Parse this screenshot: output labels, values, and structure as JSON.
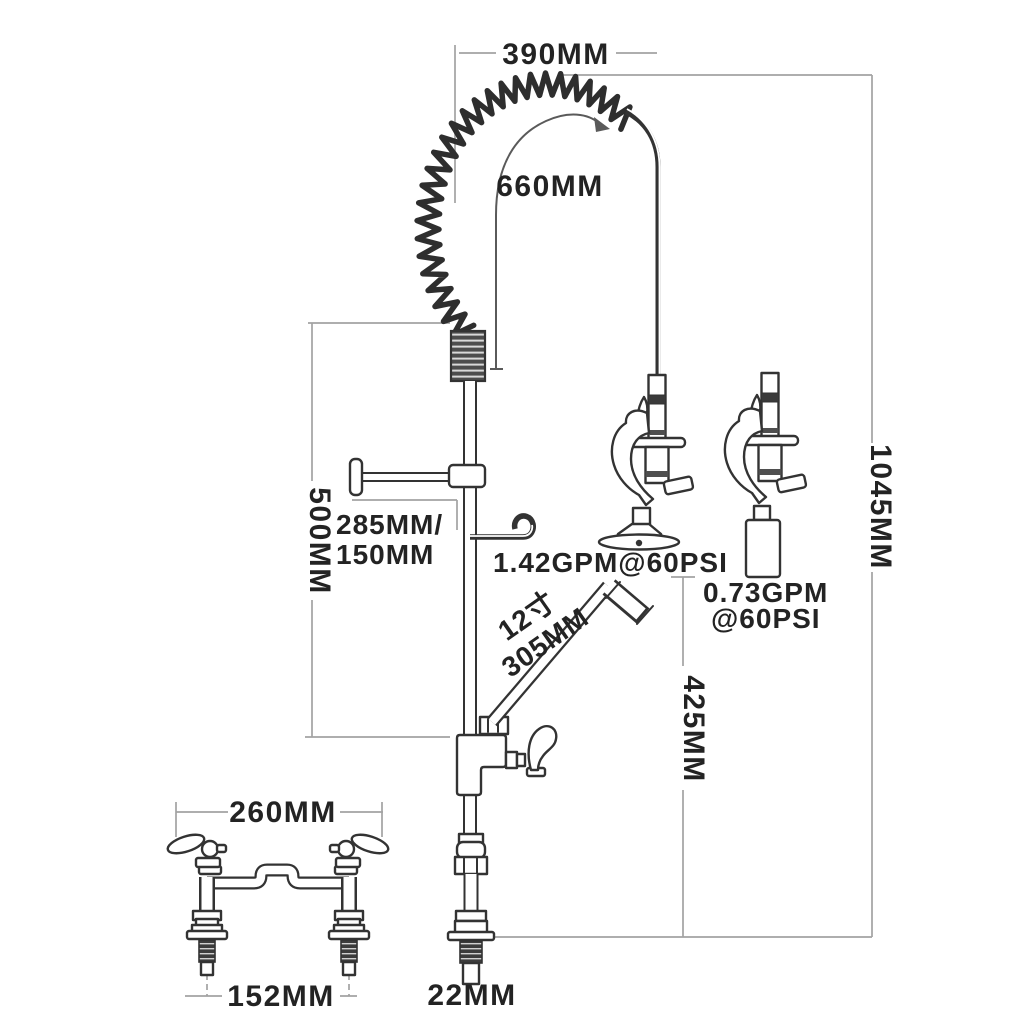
{
  "title": "Pre-rinse commercial faucet dimension diagram",
  "colors": {
    "background": "#ffffff",
    "fixture_line": "#333333",
    "dimension_line": "#a3a3a3",
    "label_text": "#232323"
  },
  "labels": {
    "hose_arc_width": "390MM",
    "hose_length": "660MM",
    "riser_height": "500MM",
    "bracket_length_line1": "285MM/",
    "bracket_length_line2": "150MM",
    "spray_valve_flow": "1.42GPM@60PSI",
    "spout_length_line1": "12寸",
    "spout_length_line2": "305MM",
    "low_flow_valve_line1": "0.73GPM",
    "low_flow_valve_line2": "@60PSI",
    "overall_height": "1045MM",
    "spout_clearance_height": "425MM",
    "deck_base_width": "260MM",
    "inlet_center_spacing": "152MM",
    "inlet_pipe_diameter": "22MM"
  }
}
